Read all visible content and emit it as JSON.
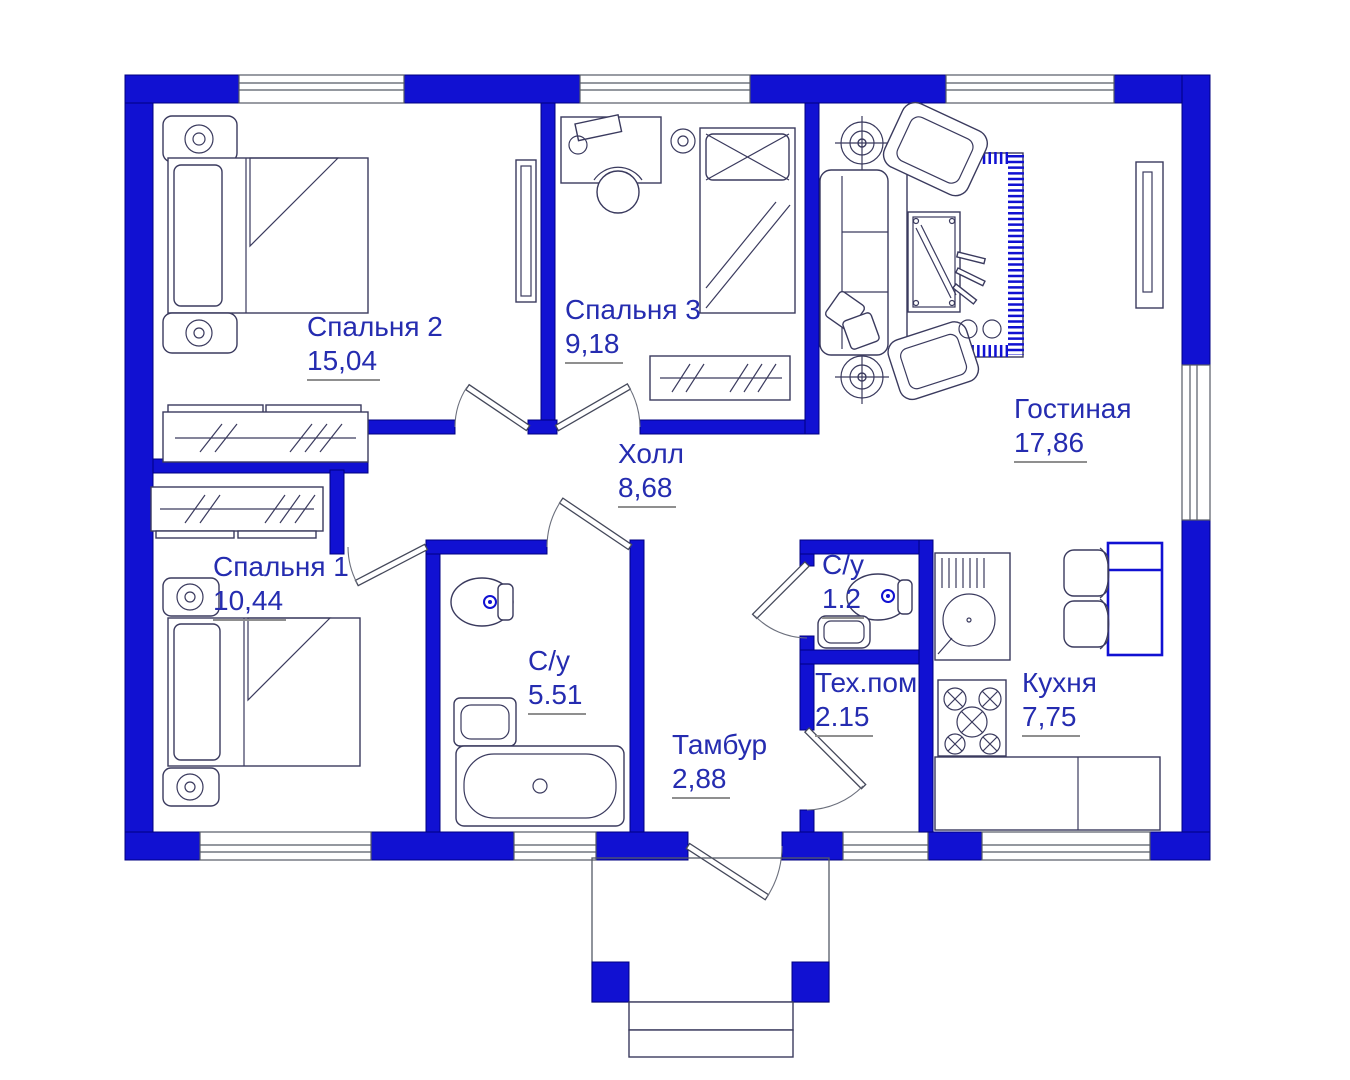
{
  "title": "План одноэтажного дома",
  "units": "м²",
  "colors": {
    "wall_blue": "#1111d2",
    "label_blue": "#252cb0",
    "line_gray": "#555a66",
    "background": "#ffffff"
  },
  "rooms": [
    {
      "id": "bedroom2",
      "name": "Спальня 2",
      "area": "15,04"
    },
    {
      "id": "bedroom3",
      "name": "Спальня 3",
      "area": "9,18"
    },
    {
      "id": "living",
      "name": "Гостиная",
      "area": "17,86"
    },
    {
      "id": "hall",
      "name": "Холл",
      "area": "8,68"
    },
    {
      "id": "bedroom1",
      "name": "Спальня 1",
      "area": "10,44"
    },
    {
      "id": "bath-main",
      "name": "С/у",
      "area": "5.51"
    },
    {
      "id": "bath-small",
      "name": "С/у",
      "area": "1.2"
    },
    {
      "id": "tech",
      "name": "Тех.пом",
      "area": "2.15"
    },
    {
      "id": "vestibule",
      "name": "Тамбур",
      "area": "2,88"
    },
    {
      "id": "kitchen",
      "name": "Кухня",
      "area": "7,75"
    }
  ]
}
